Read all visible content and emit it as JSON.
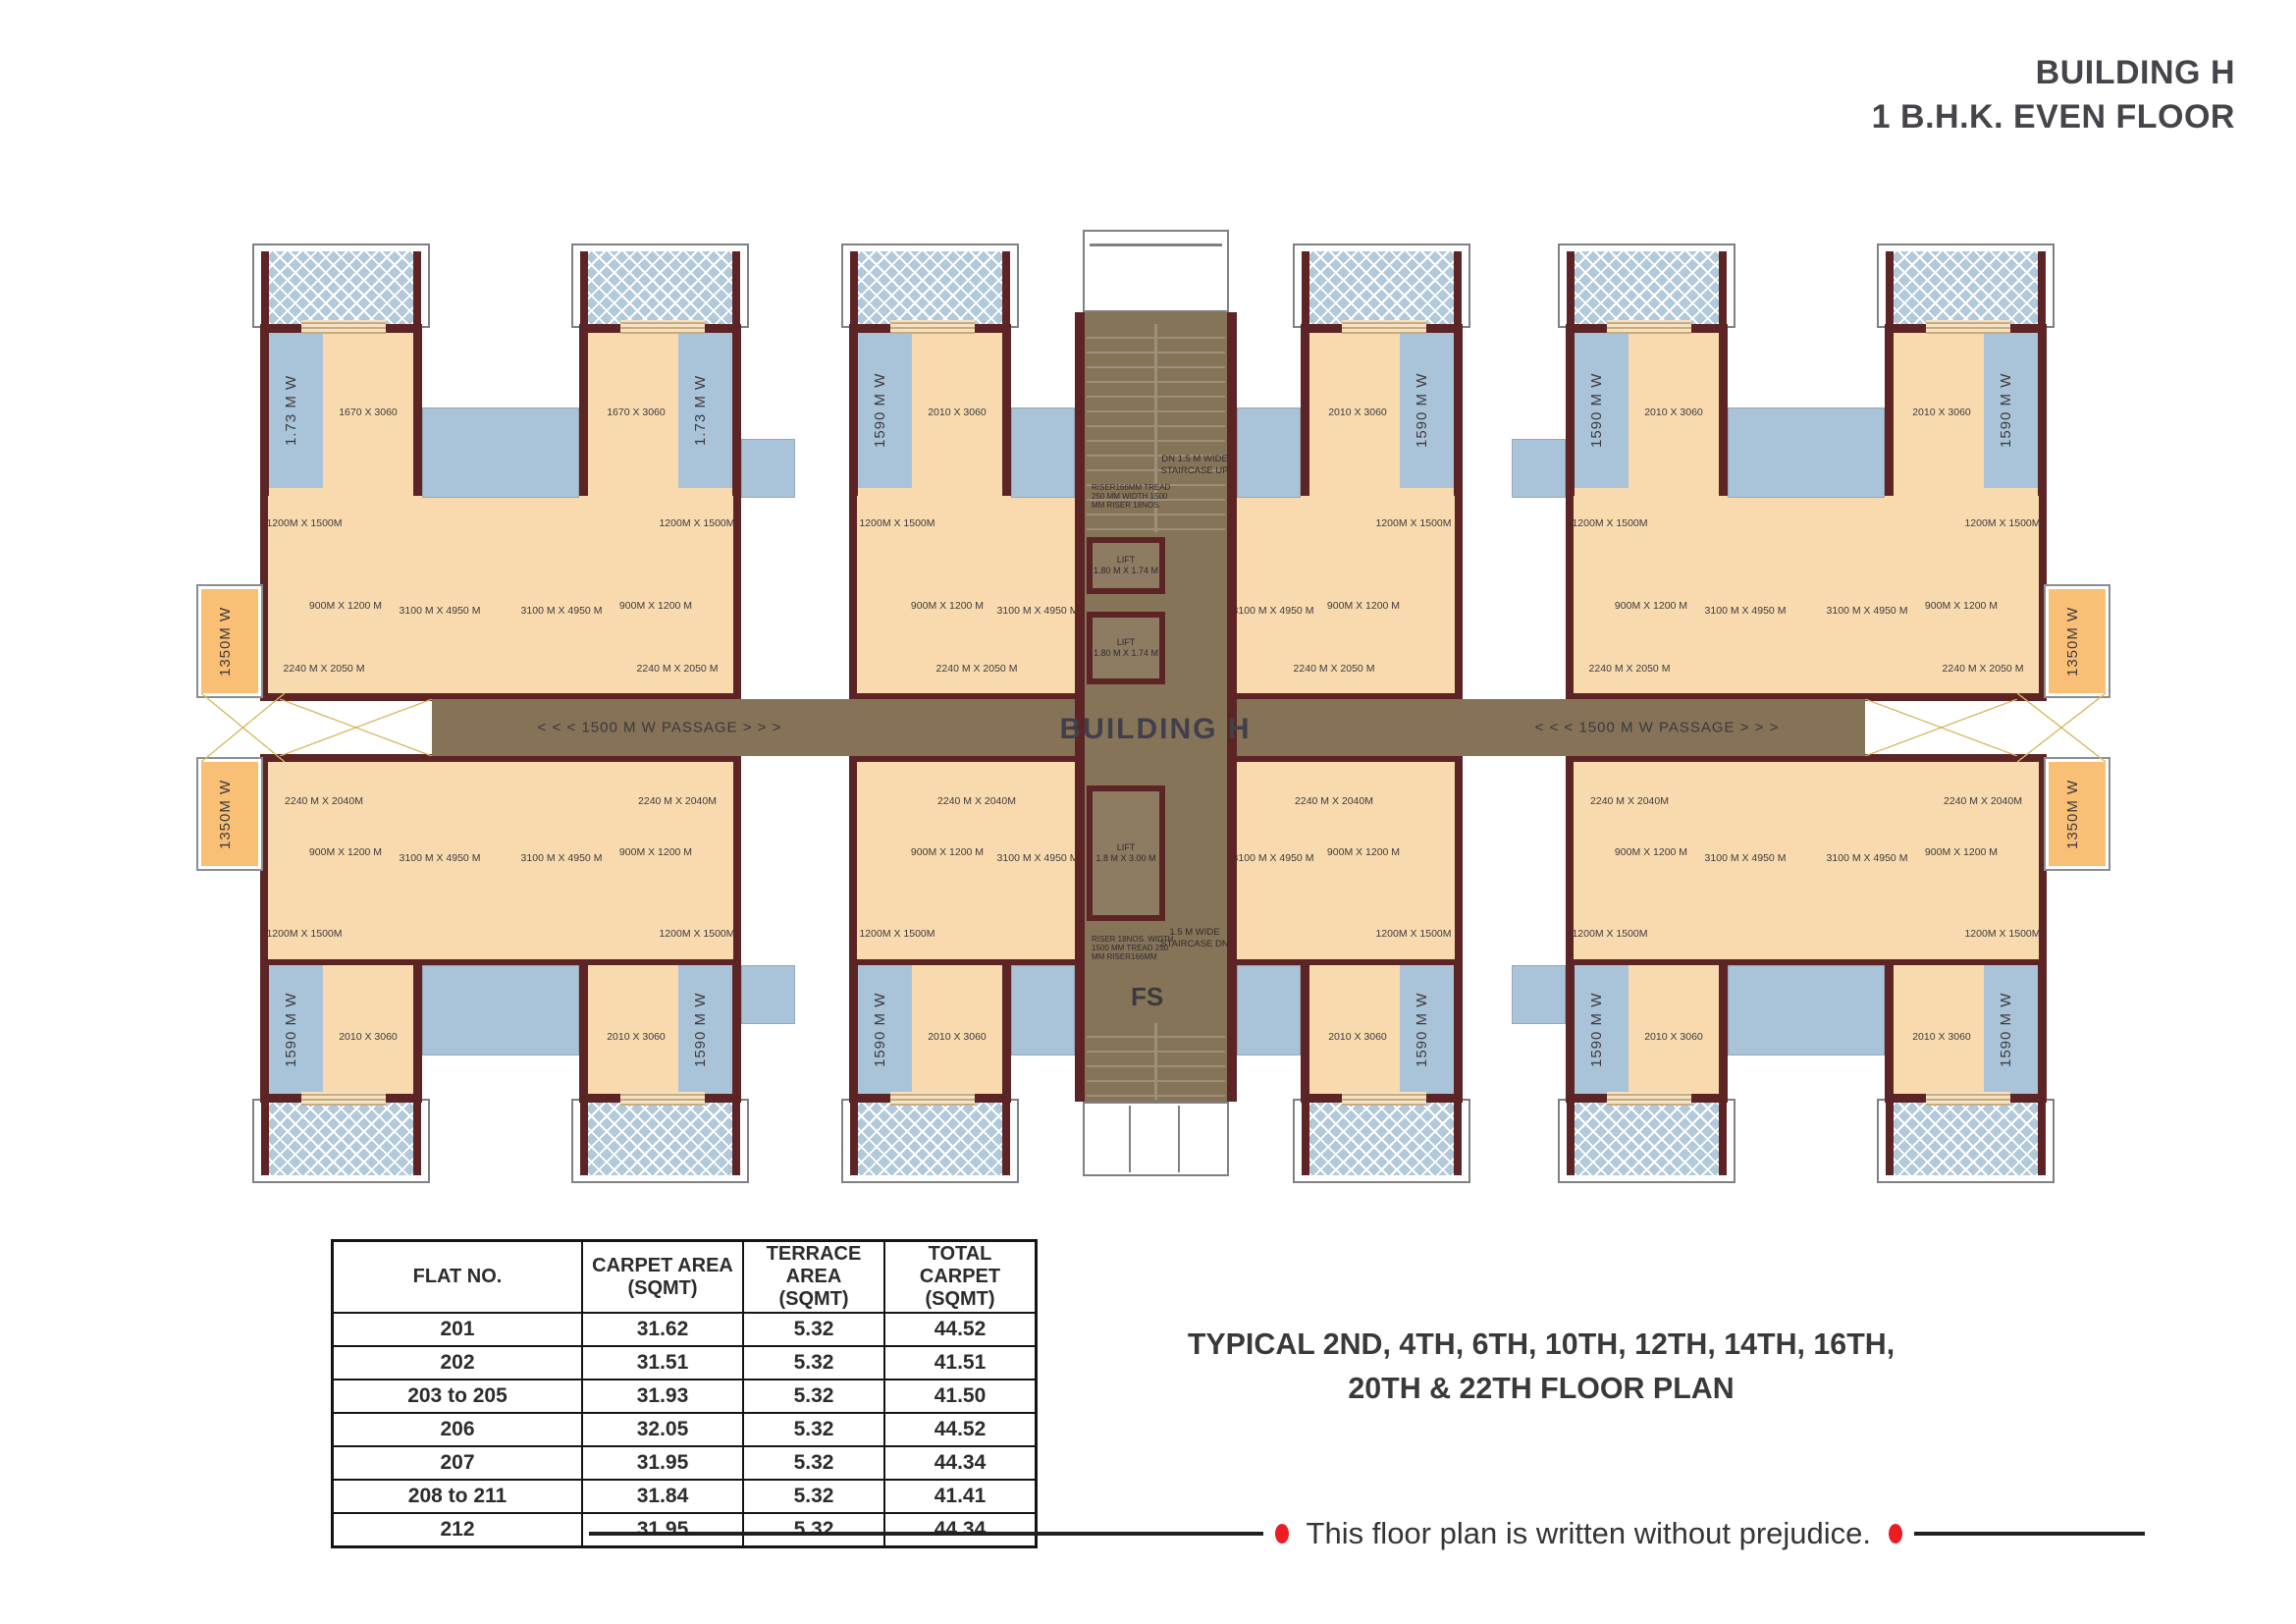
{
  "title": {
    "line1": "BUILDING H",
    "line2": "1 B.H.K. EVEN FLOOR"
  },
  "plan": {
    "building_label": "BUILDING H",
    "passage_label": "< < < 1500 M W PASSAGE > > >",
    "labels": {
      "strip_corner": "1.73 M W",
      "strip_std": "1590 M W",
      "balcony": "1350M W",
      "room_corner": "1670 X 3060",
      "room_std": "2010 X 3060",
      "toilet_big": "1200M X 1500M",
      "toilet_small": "900M X 1200 M",
      "living": "3100 M X 4950 M",
      "kitchen_top": "2240 M X 2050 M",
      "kitchen_bottom": "2240 M X 2040M"
    },
    "core": {
      "stair_top": "DN 1.5 M WIDE STAIRCASE UP",
      "riser_top": "RISER166MM TREAD 250 MM WIDTH 1500 MM RISER 18NOS.",
      "lift_label": "LIFT",
      "lift_small_size": "1.80 M X 1.74 M",
      "lift_big_size": "1.8 M X 3.00 M",
      "riser_bottom": "RISER 18NOS. WIDTH 1500 MM TREAD 250 MM RISER166MM",
      "stair_bottom": "1.5 M WIDE STAIRCASE DN",
      "fs": "FS"
    }
  },
  "table": {
    "headers": [
      {
        "line1": "FLAT NO.",
        "line2": ""
      },
      {
        "line1": "CARPET AREA",
        "line2": "(SQMT)"
      },
      {
        "line1": "TERRACE AREA",
        "line2": "(SQMT)"
      },
      {
        "line1": "TOTAL CARPET",
        "line2": "(SQMT)"
      }
    ],
    "rows": [
      {
        "flat": "201",
        "carpet": "31.62",
        "terrace": "5.32",
        "total": "44.52"
      },
      {
        "flat": "202",
        "carpet": "31.51",
        "terrace": "5.32",
        "total": "41.51"
      },
      {
        "flat": "203 to 205",
        "carpet": "31.93",
        "terrace": "5.32",
        "total": "41.50"
      },
      {
        "flat": "206",
        "carpet": "32.05",
        "terrace": "5.32",
        "total": "44.52"
      },
      {
        "flat": "207",
        "carpet": "31.95",
        "terrace": "5.32",
        "total": "44.34"
      },
      {
        "flat": "208 to 211",
        "carpet": "31.84",
        "terrace": "5.32",
        "total": "41.41"
      },
      {
        "flat": "212",
        "carpet": "31.95",
        "terrace": "5.32",
        "total": "44.34"
      }
    ]
  },
  "typical_note": {
    "line1": "TYPICAL 2ND, 4TH, 6TH, 10TH, 12TH, 14TH, 16TH,",
    "line2": "20TH & 22TH FLOOR PLAN"
  },
  "disclaimer": "This floor plan is written without prejudice.",
  "colors": {
    "wall": "#5d2425",
    "room": "#f8daae",
    "balcony_blue": "#a9c4d8",
    "terrace_hatch": "#b2c9da",
    "corridor": "#857257",
    "dry_balcony_orange": "#f9bf75",
    "accent_red": "#ec1c24",
    "text_dark": "#3b383c"
  }
}
